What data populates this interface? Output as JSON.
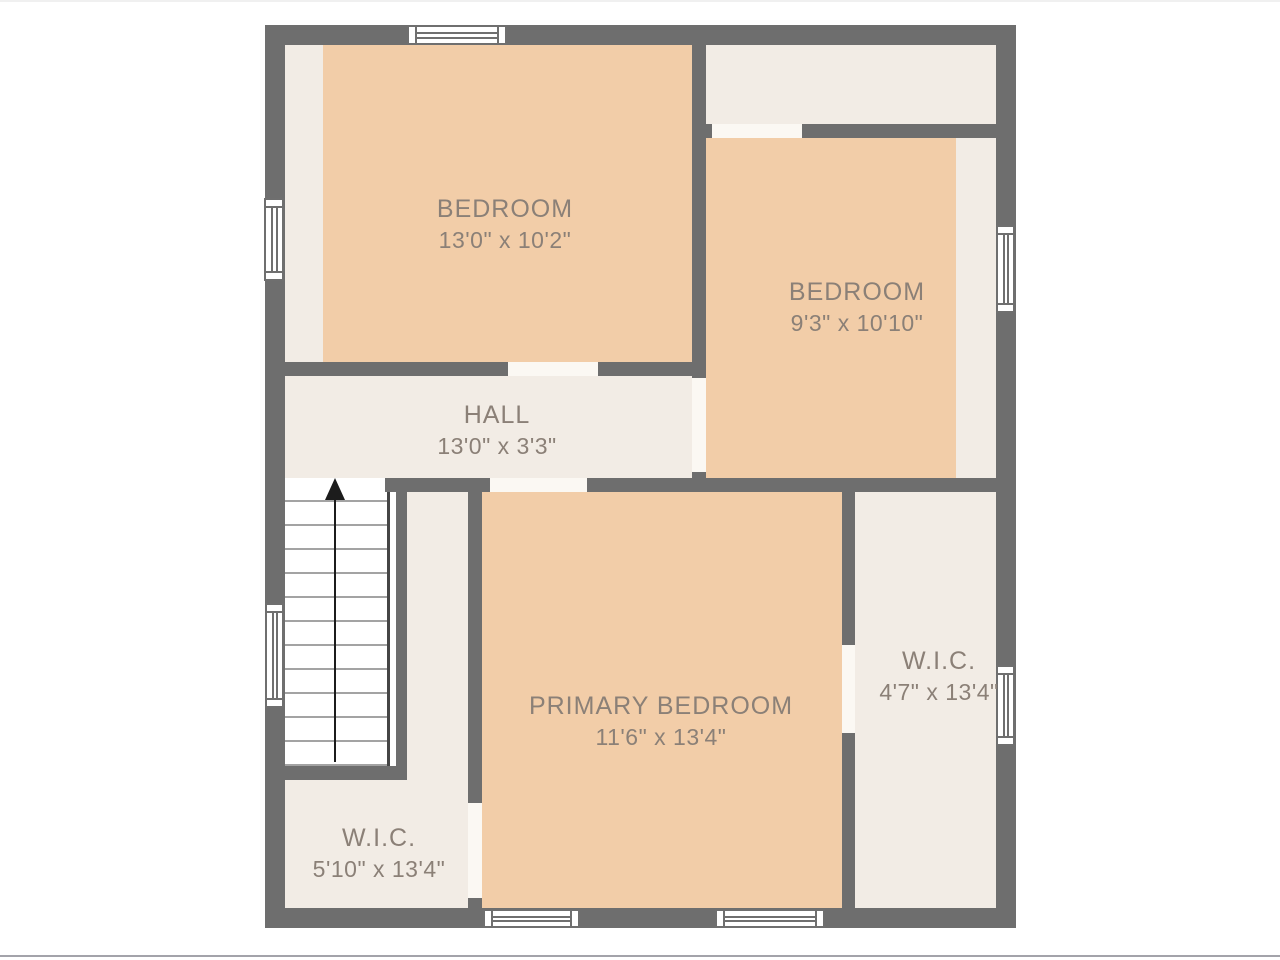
{
  "title": "Second floor plan",
  "colors": {
    "wall": "#6e6e6e",
    "room_highlight": "#f2cda8",
    "floor": "#f2ece5",
    "door_opening": "#fbf8f3",
    "stairs": "#ffffff",
    "label_text": "#8b8077"
  },
  "rooms": [
    {
      "name": "BEDROOM",
      "dimensions": "13'0\" x 10'2\""
    },
    {
      "name": "BEDROOM",
      "dimensions": "9'3\" x 10'10\""
    },
    {
      "name": "HALL",
      "dimensions": "13'0\" x 3'3\""
    },
    {
      "name": "PRIMARY BEDROOM",
      "dimensions": "11'6\" x 13'4\""
    },
    {
      "name": "W.I.C.",
      "dimensions": "4'7\" x 13'4\""
    },
    {
      "name": "W.I.C.",
      "dimensions": "5'10\" x 13'4\""
    }
  ],
  "stairs": {
    "direction_icon": "up-arrow"
  }
}
